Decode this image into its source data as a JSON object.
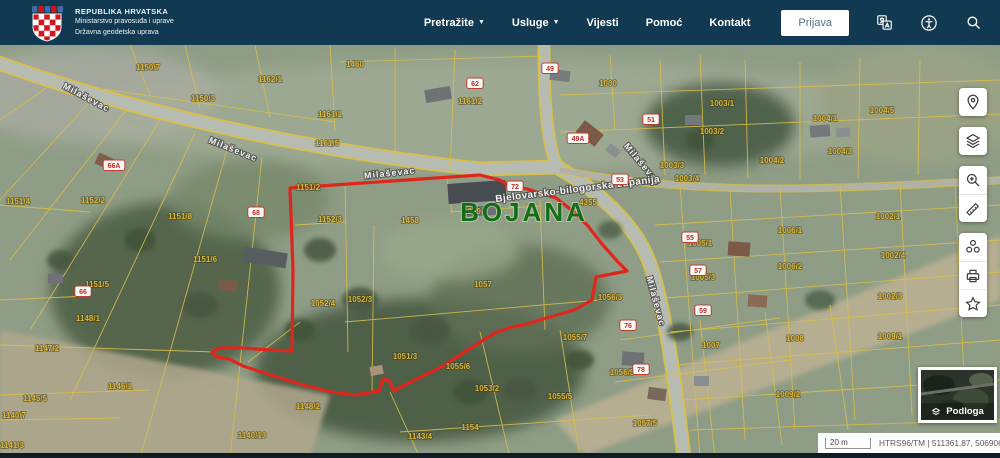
{
  "header": {
    "org": [
      "REPUBLIKA HRVATSKA",
      "Ministarstvo pravosuđa i uprave",
      "Državna geodetska uprava"
    ],
    "nav": [
      {
        "label": "Pretražite",
        "dropdown": true
      },
      {
        "label": "Usluge",
        "dropdown": true
      },
      {
        "label": "Vijesti",
        "dropdown": false
      },
      {
        "label": "Pomoć",
        "dropdown": false
      },
      {
        "label": "Kontakt",
        "dropdown": false
      }
    ],
    "login_label": "Prijava",
    "icons": [
      "translate-icon",
      "accessibility-icon",
      "search-icon"
    ],
    "background_color": "#113a52"
  },
  "map": {
    "settlement_label": "BOJANA",
    "region_label": "Bjelovarsko-bilogorska županija",
    "street_labels": [
      {
        "text": "Milaševac",
        "x": 85,
        "y": 100,
        "angle": 28
      },
      {
        "text": "Milaševac",
        "x": 232,
        "y": 152,
        "angle": 22
      },
      {
        "text": "Milaševac",
        "x": 390,
        "y": 176,
        "angle": -6
      },
      {
        "text": "Milaševac",
        "x": 640,
        "y": 166,
        "angle": 50
      },
      {
        "text": "Milaševac",
        "x": 653,
        "y": 302,
        "angle": 75
      }
    ],
    "selected_parcel": {
      "color": "#e0261c",
      "points": "290,188 480,175 500,180 506,184 527,189 556,198 574,212 588,226 602,244 618,262 627,271 596,277 592,300 574,310 523,325 512,327 495,333 469,349 443,366 419,378 401,387 394,391 389,380 383,379 379,391 356,395 331,392 300,384 271,375 243,366 229,359 217,357 212,352 219,348 242,348 270,350 292,351 293,270 290,188"
    },
    "parcel_line_color": "#d9bf4a",
    "parcel_labels": [
      {
        "t": "1150/7",
        "x": 148,
        "y": 70
      },
      {
        "t": "1162/1",
        "x": 270,
        "y": 82
      },
      {
        "t": "1460",
        "x": 355,
        "y": 67
      },
      {
        "t": "1150/3",
        "x": 203,
        "y": 101
      },
      {
        "t": "1161/1",
        "x": 330,
        "y": 117
      },
      {
        "t": "1161/2",
        "x": 470,
        "y": 104
      },
      {
        "t": "1161/5",
        "x": 327,
        "y": 146
      },
      {
        "t": "1000",
        "x": 608,
        "y": 86
      },
      {
        "t": "1003/1",
        "x": 722,
        "y": 106
      },
      {
        "t": "1004/1",
        "x": 825,
        "y": 121
      },
      {
        "t": "1004/5",
        "x": 882,
        "y": 113
      },
      {
        "t": "1003/2",
        "x": 712,
        "y": 134
      },
      {
        "t": "1004/2",
        "x": 772,
        "y": 163
      },
      {
        "t": "1004/3",
        "x": 840,
        "y": 154
      },
      {
        "t": "1003/3",
        "x": 672,
        "y": 168
      },
      {
        "t": "1003/4",
        "x": 687,
        "y": 181
      },
      {
        "t": "1001/2",
        "x": 645,
        "y": 184
      },
      {
        "t": "1151/4",
        "x": 18,
        "y": 204
      },
      {
        "t": "1152/2",
        "x": 93,
        "y": 203
      },
      {
        "t": "1151/8",
        "x": 180,
        "y": 219
      },
      {
        "t": "1151/6",
        "x": 205,
        "y": 262
      },
      {
        "t": "1151/2",
        "x": 308,
        "y": 190
      },
      {
        "t": "1152/3",
        "x": 330,
        "y": 222
      },
      {
        "t": "1458",
        "x": 410,
        "y": 223
      },
      {
        "t": "1369",
        "x": 472,
        "y": 214
      },
      {
        "t": "4355",
        "x": 588,
        "y": 205
      },
      {
        "t": "1057",
        "x": 483,
        "y": 287
      },
      {
        "t": "1052/4",
        "x": 323,
        "y": 306
      },
      {
        "t": "1052/3",
        "x": 360,
        "y": 302
      },
      {
        "t": "1151/5",
        "x": 97,
        "y": 287
      },
      {
        "t": "1148/1",
        "x": 88,
        "y": 321
      },
      {
        "t": "1147/2",
        "x": 47,
        "y": 351
      },
      {
        "t": "1146/1",
        "x": 120,
        "y": 389
      },
      {
        "t": "1145/5",
        "x": 35,
        "y": 401
      },
      {
        "t": "1140/7",
        "x": 14,
        "y": 418
      },
      {
        "t": "1141/3",
        "x": 12,
        "y": 448
      },
      {
        "t": "1148/2",
        "x": 308,
        "y": 409
      },
      {
        "t": "1140/13",
        "x": 252,
        "y": 438
      },
      {
        "t": "1051/3",
        "x": 405,
        "y": 359
      },
      {
        "t": "1055/6",
        "x": 458,
        "y": 369
      },
      {
        "t": "1053/2",
        "x": 487,
        "y": 391
      },
      {
        "t": "1154",
        "x": 470,
        "y": 430
      },
      {
        "t": "1143/4",
        "x": 420,
        "y": 439
      },
      {
        "t": "1055/5",
        "x": 560,
        "y": 399
      },
      {
        "t": "1055/7",
        "x": 575,
        "y": 340
      },
      {
        "t": "1056/3",
        "x": 610,
        "y": 300
      },
      {
        "t": "1056/5",
        "x": 622,
        "y": 375
      },
      {
        "t": "1057/5",
        "x": 645,
        "y": 426
      },
      {
        "t": "1005/1",
        "x": 700,
        "y": 246
      },
      {
        "t": "1005/3",
        "x": 703,
        "y": 280
      },
      {
        "t": "1006/1",
        "x": 790,
        "y": 233
      },
      {
        "t": "1006/2",
        "x": 790,
        "y": 269
      },
      {
        "t": "1002/1",
        "x": 888,
        "y": 219
      },
      {
        "t": "1002/4",
        "x": 893,
        "y": 258
      },
      {
        "t": "1002/3",
        "x": 890,
        "y": 299
      },
      {
        "t": "1009/1",
        "x": 890,
        "y": 339
      },
      {
        "t": "1008",
        "x": 795,
        "y": 341
      },
      {
        "t": "1007",
        "x": 711,
        "y": 348
      },
      {
        "t": "1009/2",
        "x": 788,
        "y": 397
      },
      {
        "t": "1040",
        "x": 935,
        "y": 408
      }
    ],
    "house_numbers": [
      {
        "t": "66A",
        "x": 114,
        "y": 166
      },
      {
        "t": "68",
        "x": 256,
        "y": 213
      },
      {
        "t": "66",
        "x": 83,
        "y": 292
      },
      {
        "t": "62",
        "x": 475,
        "y": 84
      },
      {
        "t": "49",
        "x": 550,
        "y": 69
      },
      {
        "t": "49A",
        "x": 578,
        "y": 139
      },
      {
        "t": "51",
        "x": 651,
        "y": 120
      },
      {
        "t": "53",
        "x": 620,
        "y": 180
      },
      {
        "t": "72",
        "x": 515,
        "y": 187
      },
      {
        "t": "55",
        "x": 690,
        "y": 238
      },
      {
        "t": "57",
        "x": 698,
        "y": 271
      },
      {
        "t": "59",
        "x": 703,
        "y": 311
      },
      {
        "t": "76",
        "x": 628,
        "y": 326
      },
      {
        "t": "78",
        "x": 641,
        "y": 370
      }
    ]
  },
  "toolbar": {
    "buttons": [
      {
        "name": "locate",
        "icon": "location-pin-icon"
      },
      {
        "name": "layers",
        "icon": "layers-icon"
      },
      {
        "name": "zoom-area",
        "icon": "magnifier-plus-icon"
      },
      {
        "name": "measure",
        "icon": "ruler-icon"
      },
      {
        "name": "share",
        "icon": "share-icon"
      },
      {
        "name": "print",
        "icon": "printer-icon"
      },
      {
        "name": "favorites",
        "icon": "star-icon"
      }
    ]
  },
  "basemap": {
    "label": "Podloga"
  },
  "statusbar": {
    "scale_label": "20 m",
    "crs_coords": "HTRS96/TM | 511361.87, 5069069.98"
  }
}
